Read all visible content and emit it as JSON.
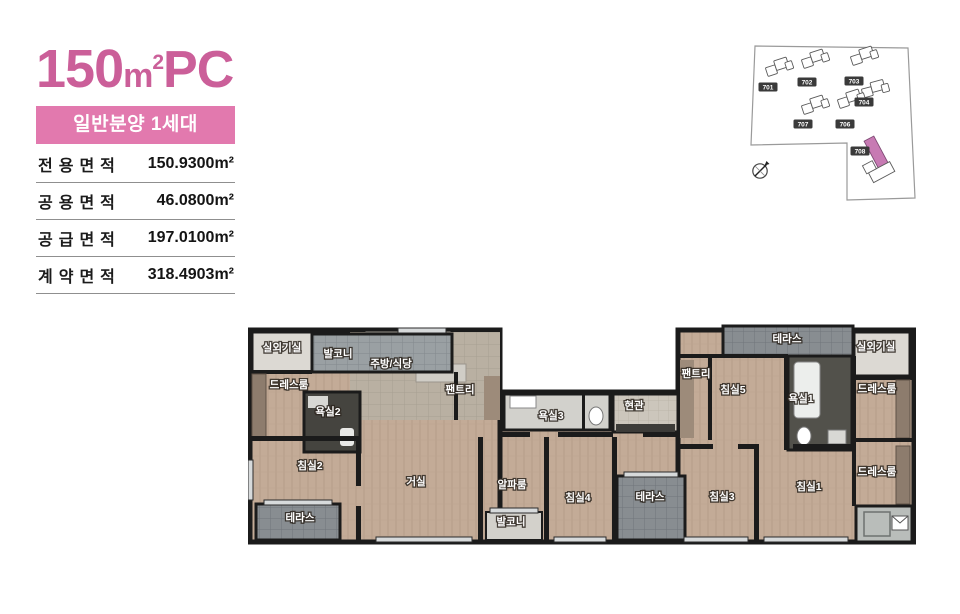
{
  "header": {
    "title": {
      "number": "150",
      "unit": "m",
      "sup": "2",
      "suffix": "PC"
    },
    "badge_label": "일반분양 1세대"
  },
  "area_table": {
    "rows": [
      {
        "label": "전용면적",
        "value": "150.9300m²"
      },
      {
        "label": "공용면적",
        "value": "46.0800m²"
      },
      {
        "label": "공급면적",
        "value": "197.0100m²"
      },
      {
        "label": "계약면적",
        "value": "318.4903m²"
      }
    ]
  },
  "site_map": {
    "buildings": [
      {
        "id": "701",
        "x": 22,
        "y": 57,
        "highlighted": false
      },
      {
        "id": "702",
        "x": 61,
        "y": 52,
        "highlighted": false
      },
      {
        "id": "703",
        "x": 108,
        "y": 51,
        "highlighted": false
      },
      {
        "id": "704",
        "x": 118,
        "y": 72,
        "highlighted": false
      },
      {
        "id": "707",
        "x": 57,
        "y": 94,
        "highlighted": false
      },
      {
        "id": "706",
        "x": 99,
        "y": 94,
        "highlighted": false
      },
      {
        "id": "708",
        "x": 114,
        "y": 121,
        "highlighted": true
      }
    ],
    "compass_icon": "north-needle-compass"
  },
  "floor_plan": {
    "rooms": [
      {
        "label": "실외기실",
        "x": 34,
        "y": 31,
        "fs": 8.5
      },
      {
        "label": "발코니",
        "x": 90,
        "y": 37,
        "fs": 9.5
      },
      {
        "label": "주방/식당",
        "x": 143,
        "y": 47,
        "fs": 10.5
      },
      {
        "label": "팬트리",
        "x": 212,
        "y": 73,
        "fs": 9.5
      },
      {
        "label": "드레스룸",
        "x": 41,
        "y": 68,
        "fs": 9.5
      },
      {
        "label": "욕실2",
        "x": 80,
        "y": 95,
        "fs": 9.5
      },
      {
        "label": "침실2",
        "x": 62,
        "y": 149,
        "fs": 10.5
      },
      {
        "label": "테라스",
        "x": 52,
        "y": 201,
        "fs": 9.5
      },
      {
        "label": "거실",
        "x": 168,
        "y": 165,
        "fs": 11
      },
      {
        "label": "욕실3",
        "x": 303,
        "y": 99,
        "fs": 9.5
      },
      {
        "label": "현관",
        "x": 386,
        "y": 89,
        "fs": 9.5
      },
      {
        "label": "알파룸",
        "x": 264,
        "y": 168,
        "fs": 10
      },
      {
        "label": "발코니",
        "x": 263,
        "y": 205,
        "fs": 9
      },
      {
        "label": "침실4",
        "x": 330,
        "y": 181,
        "fs": 10.5
      },
      {
        "label": "테라스",
        "x": 402,
        "y": 180,
        "fs": 9.5
      },
      {
        "label": "팬트리",
        "x": 448,
        "y": 57,
        "fs": 9.5
      },
      {
        "label": "침실5",
        "x": 485,
        "y": 73,
        "fs": 10.5
      },
      {
        "label": "테라스",
        "x": 539,
        "y": 22,
        "fs": 9.5
      },
      {
        "label": "실외기실",
        "x": 628,
        "y": 30,
        "fs": 8.5
      },
      {
        "label": "욕실1",
        "x": 553,
        "y": 82,
        "fs": 9.5
      },
      {
        "label": "드레스룸",
        "x": 629,
        "y": 72,
        "fs": 9
      },
      {
        "label": "드레스룸",
        "x": 629,
        "y": 155,
        "fs": 9
      },
      {
        "label": "침실3",
        "x": 474,
        "y": 180,
        "fs": 10.5
      },
      {
        "label": "침실1",
        "x": 561,
        "y": 170,
        "fs": 10.5
      }
    ]
  },
  "colors": {
    "accent_pink": "#cb5f99",
    "badge_pink": "#e279ae",
    "highlight_building": "#c77ab3"
  }
}
